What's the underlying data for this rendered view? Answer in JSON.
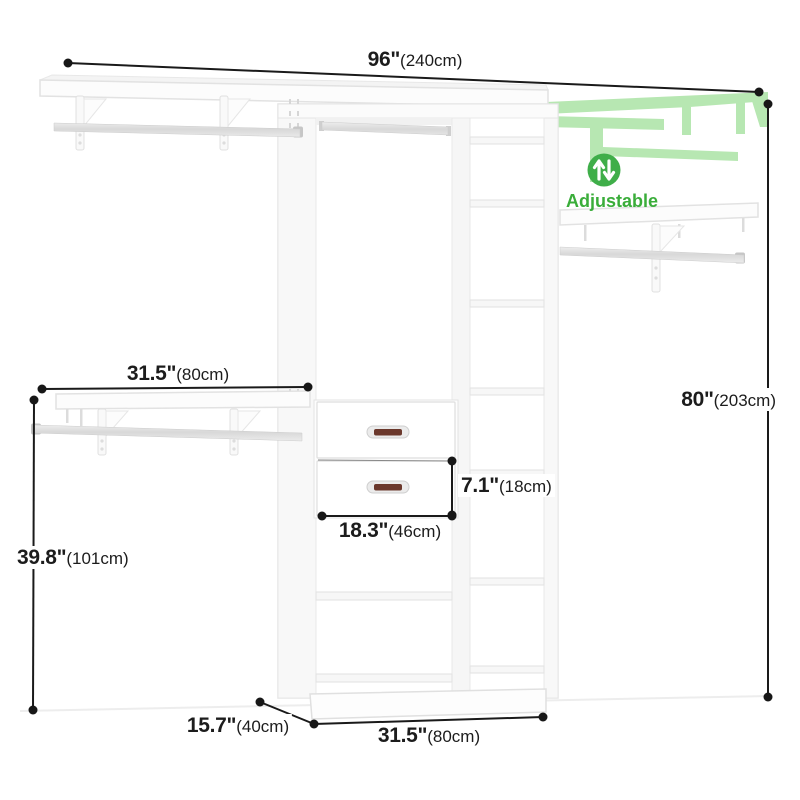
{
  "badge": {
    "label": "Adjustable"
  },
  "dimensions": {
    "top_width": {
      "inches": "96\"",
      "cm": "(240cm)"
    },
    "height": {
      "inches": "80\"",
      "cm": "(203cm)"
    },
    "left_rod_width": {
      "inches": "31.5\"",
      "cm": "(80cm)"
    },
    "left_rod_height": {
      "inches": "39.8\"",
      "cm": "(101cm)"
    },
    "depth": {
      "inches": "15.7\"",
      "cm": "(40cm)"
    },
    "tower_width": {
      "inches": "31.5\"",
      "cm": "(80cm)"
    },
    "drawer_height": {
      "inches": "7.1\"",
      "cm": "(18cm)"
    },
    "drawer_width": {
      "inches": "18.3\"",
      "cm": "(46cm)"
    }
  },
  "colors": {
    "accent_green": "#3fae49",
    "ghost_green": "#b7e7b2",
    "dimension_line": "#1a1a1a",
    "handle": "#6b382c"
  }
}
